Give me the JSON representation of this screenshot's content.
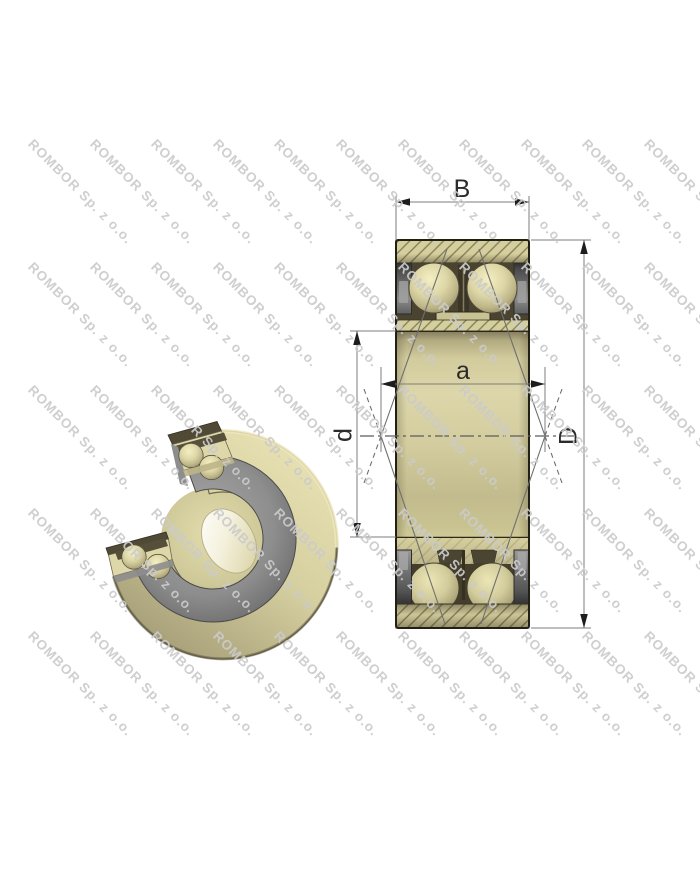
{
  "watermark": {
    "text": "ROMBOR Sp. z o.o."
  },
  "diagram": {
    "labels": {
      "width": "B",
      "outer_diameter": "D",
      "bore_diameter": "d",
      "load_center_distance": "a"
    }
  }
}
